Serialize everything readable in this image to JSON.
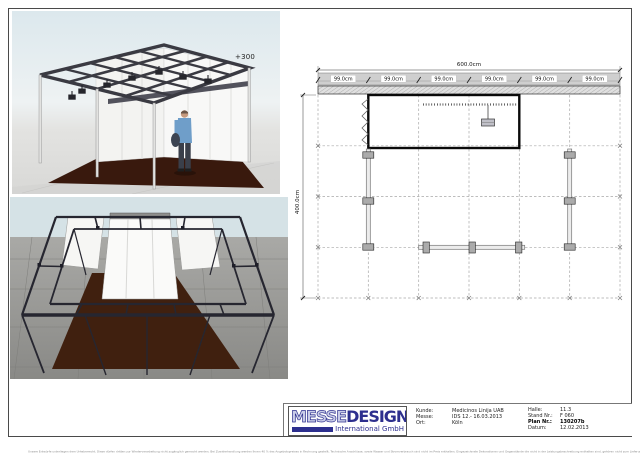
{
  "sheet": {
    "disclaimer": "Unsere Entwürfe unterliegen dem Urheberrecht. Diese dürfen dritten zur Wiederverarbeitung nicht zugänglich gemacht werden. Bei Zuwiderhandlung werden Ihnen 40 % des Angebotspreises in Rechnung gestellt. Technische Anschlüsse, sowie Wasser und Stromverbrauch sind nicht im Preis enthalten. Eingezeichnete Dekorationen und Gegenstände die nicht in der Leistungsbeschreibung enthalten sind, gehören nicht zum Lieferumfang, Änderungen durch die Messe bleiben vorbehalten."
  },
  "plan": {
    "elevation_label": "+300",
    "total_width_label": "600.0cm",
    "height_label": "400.0cm",
    "segment_labels": [
      "99.0cm",
      "99.0cm",
      "99.0cm",
      "99.0cm",
      "99.0cm",
      "99.0cm"
    ]
  },
  "title_block": {
    "logo": {
      "outline_text": "MESSE",
      "solid_text": "DESIGN",
      "subtitle": "International GmbH",
      "brand_color": "#2d2f8e"
    },
    "left_fields": [
      {
        "label": "Kunde:",
        "value": "Medicinos Linija UAB"
      },
      {
        "label": "Messe:",
        "value": "IDS 12.- 16.03.2013"
      },
      {
        "label": "Ort:",
        "value": "Köln"
      }
    ],
    "right_fields": [
      {
        "label": "Halle:",
        "value": "11.3"
      },
      {
        "label": "Stand Nr.:",
        "value": "F 060"
      },
      {
        "label": "Plan Nr.:",
        "value": "130207b"
      },
      {
        "label": "Datum:",
        "value": "12.02.2013"
      }
    ]
  }
}
